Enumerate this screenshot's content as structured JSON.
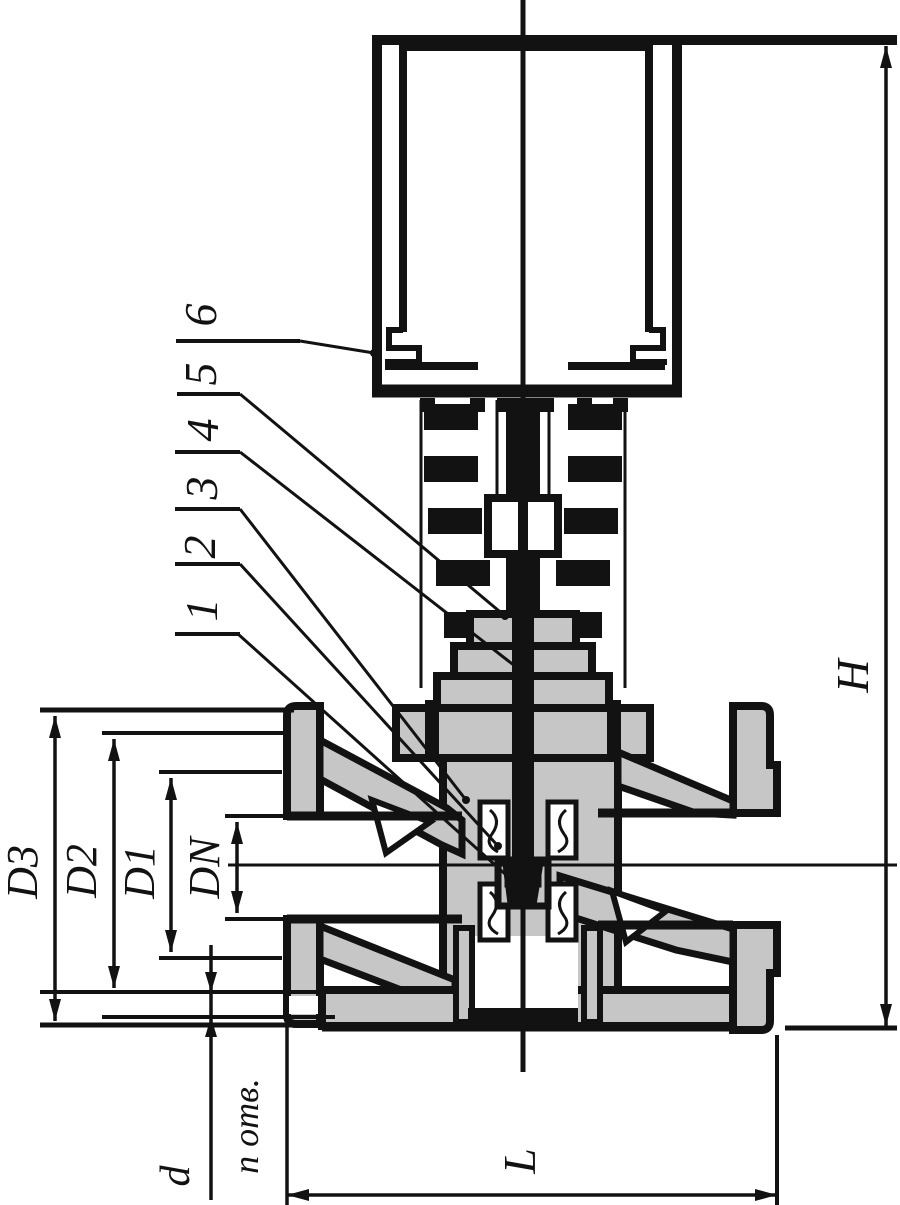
{
  "drawing": {
    "kind": "valve-cross-section",
    "colors": {
      "line": "#121212",
      "body_fill": "#c6c6c6",
      "background": "#ffffff"
    },
    "dimensions": {
      "height": "H",
      "length": "L",
      "flange_outer_diameter": "D3",
      "bolt_circle_diameter": "D2",
      "raised_face_diameter": "D1",
      "nominal_bore": "DN",
      "bolt_hole_diameter": "d",
      "holes_note": "n отв."
    },
    "callouts": [
      {
        "number": "1"
      },
      {
        "number": "2"
      },
      {
        "number": "3"
      },
      {
        "number": "4"
      },
      {
        "number": "5"
      },
      {
        "number": "6"
      }
    ]
  }
}
